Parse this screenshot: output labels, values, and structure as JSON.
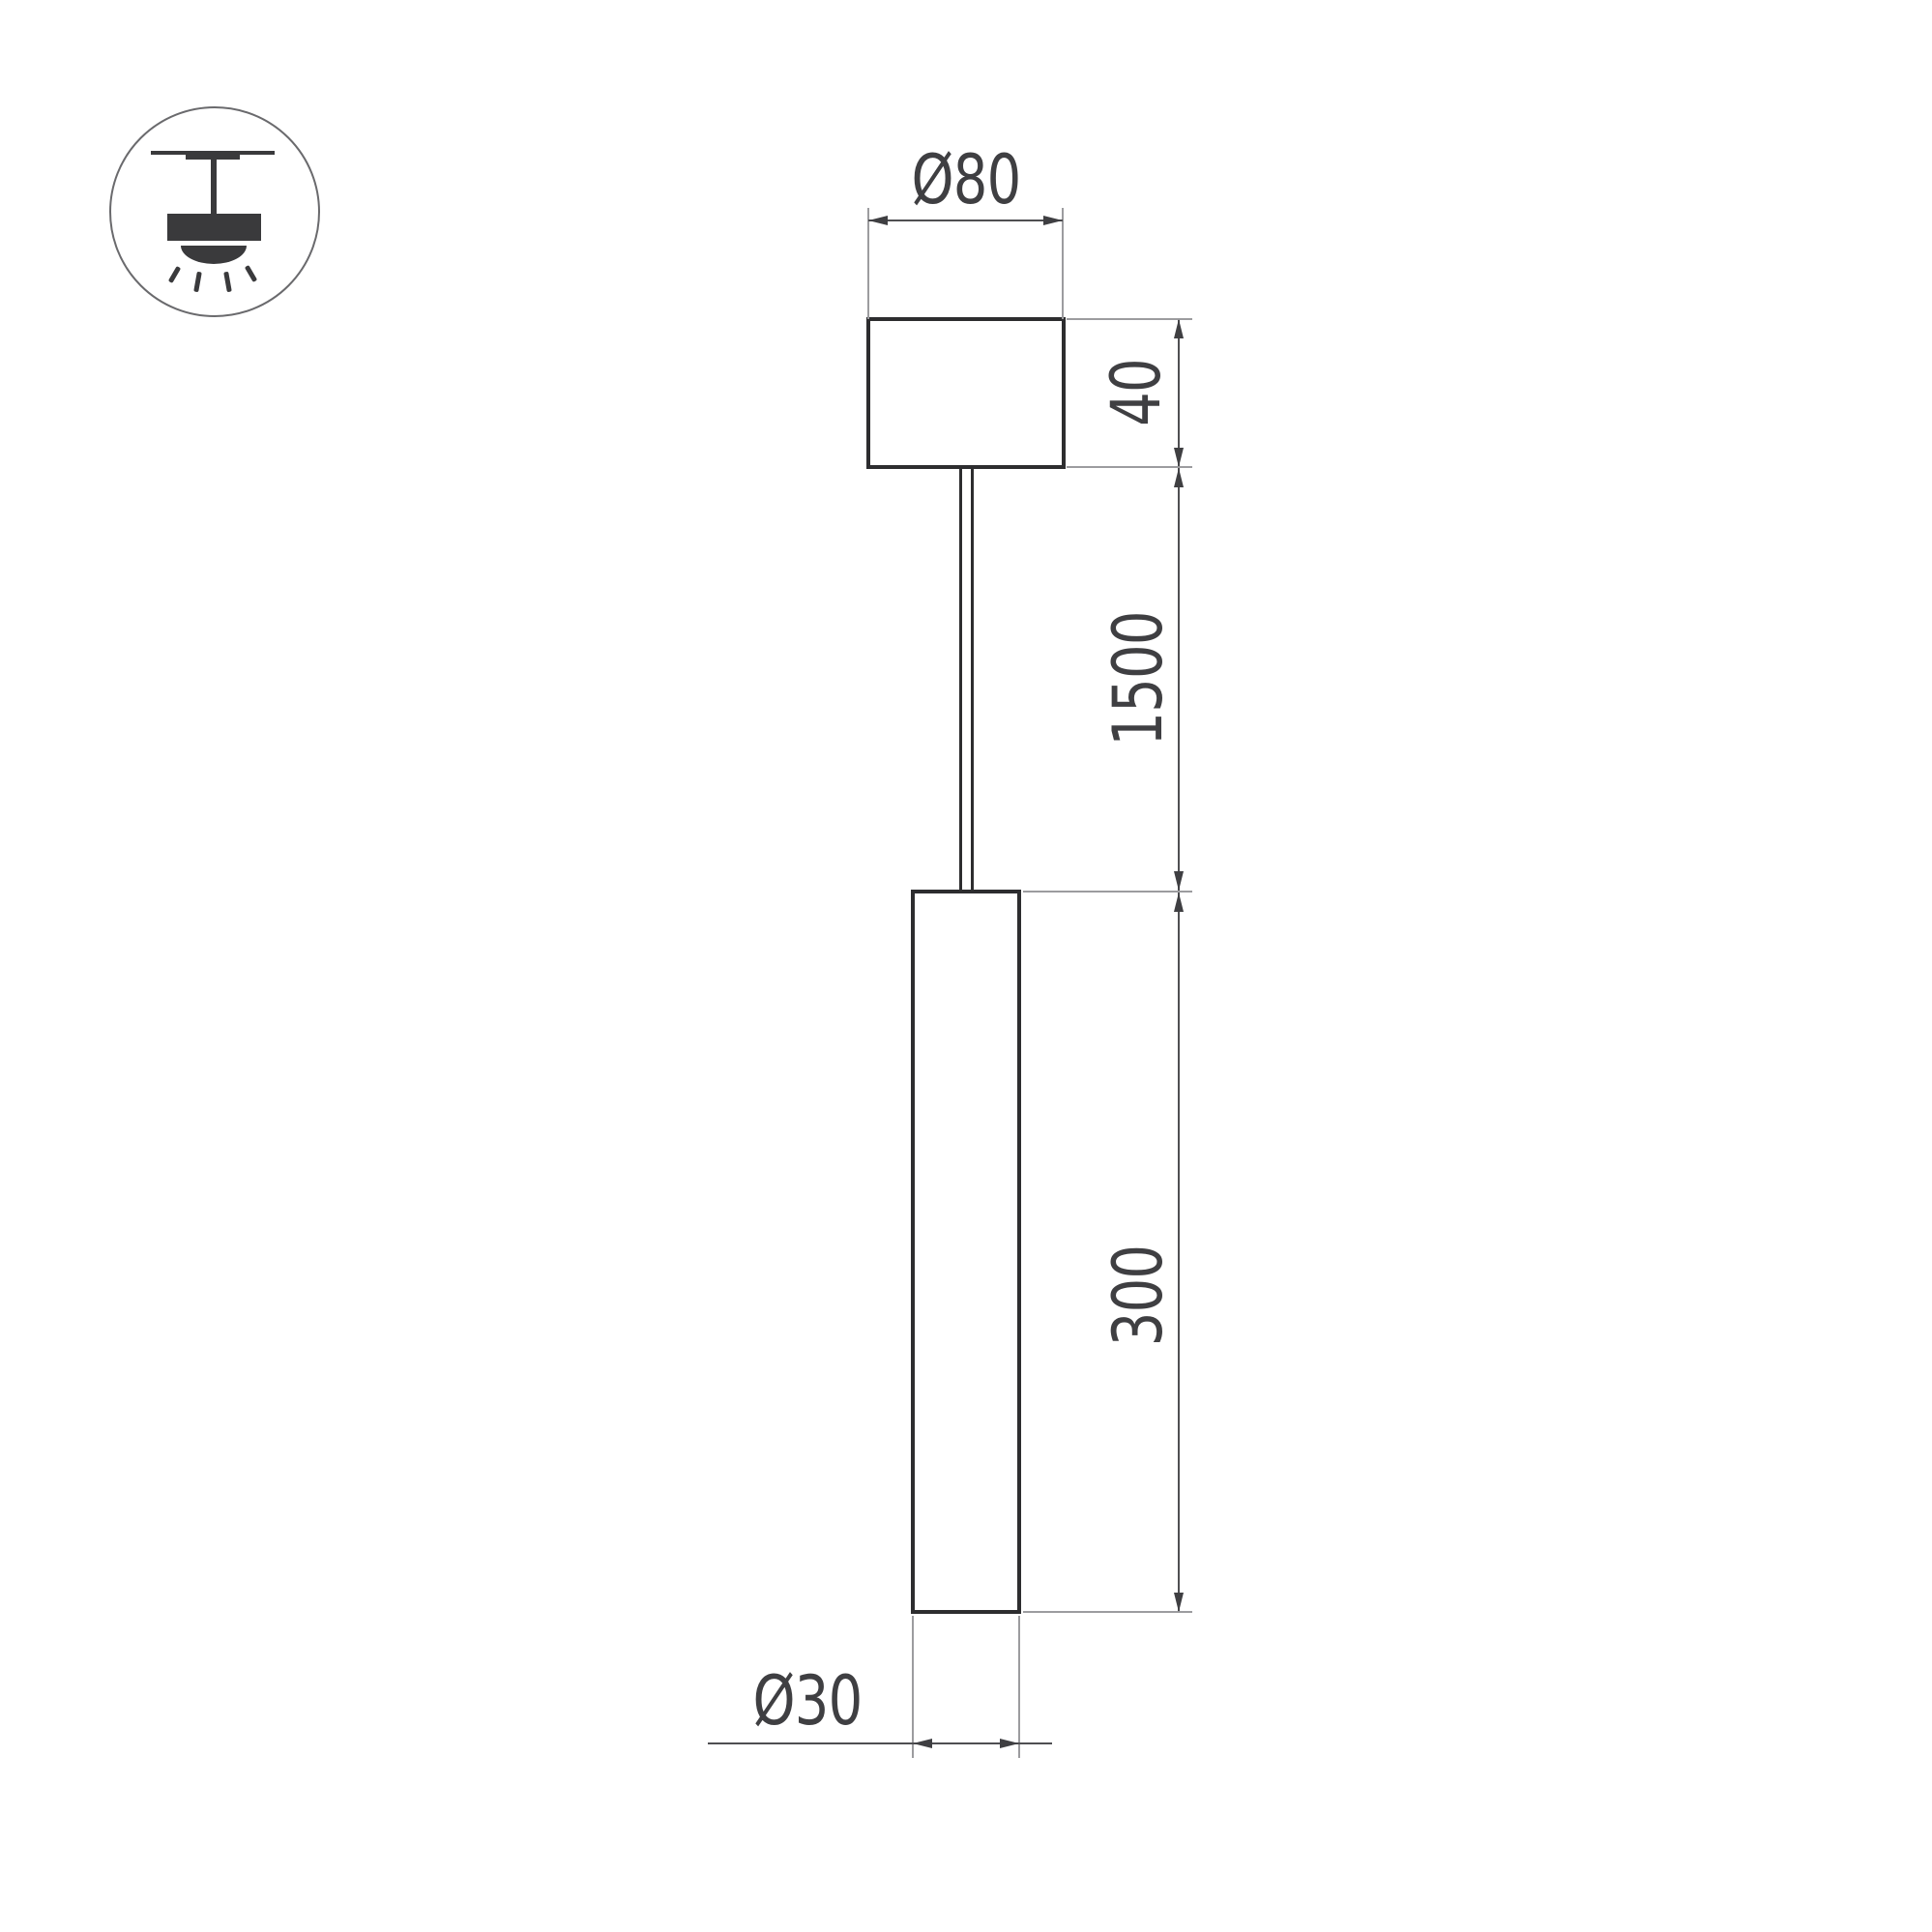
{
  "drawing": {
    "title": "pendant-luminaire-dimension-drawing",
    "labels": {
      "canopy_diameter": "Ø80",
      "canopy_height": "40",
      "suspension_length": "1500",
      "tube_length": "300",
      "tube_diameter": "Ø30"
    },
    "icon": {
      "name": "pendant-ceiling-mount-icon"
    },
    "colors": {
      "background": "#ffffff",
      "object_stroke": "#2d2d2f",
      "dimension_line": "#4f4f52",
      "extension_line": "#9c9c9f",
      "arrow_and_text": "#3f3f42",
      "icon_fill": "#3a3a3c"
    }
  }
}
